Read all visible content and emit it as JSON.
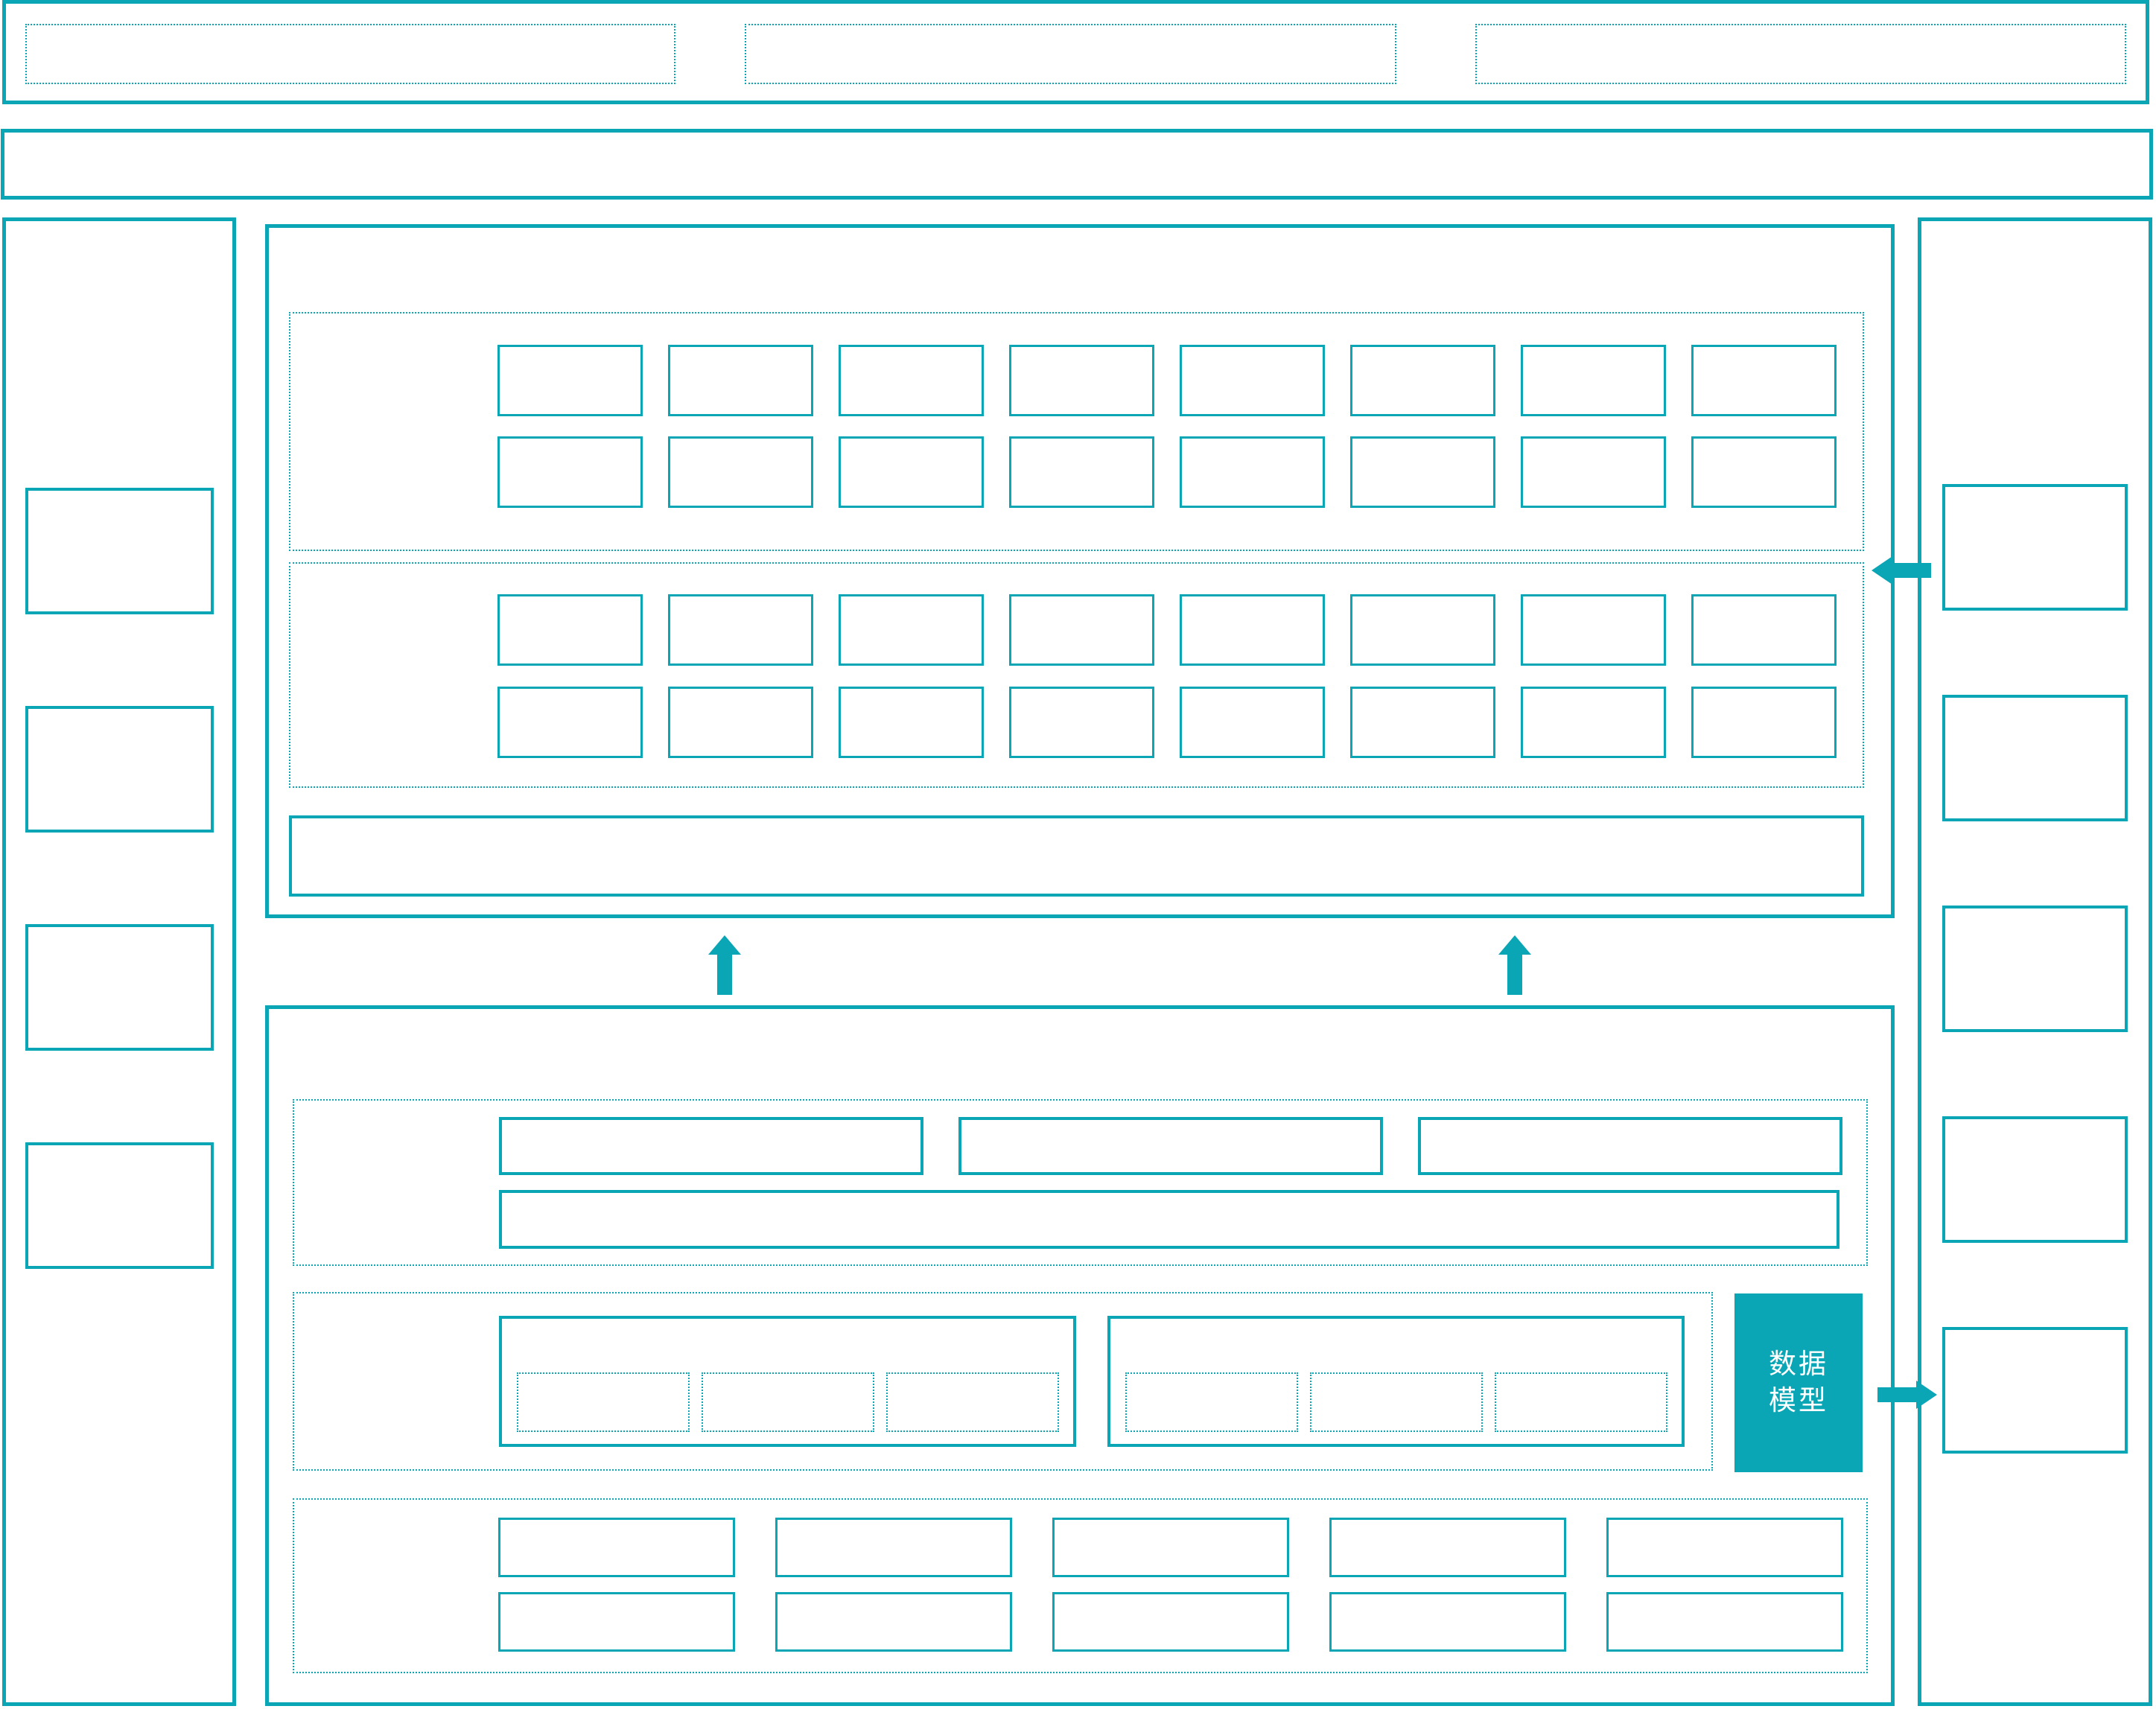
{
  "colors": {
    "accent": "#0aa6b5",
    "background": "#ffffff",
    "data_model_bg": "#0aa6b5",
    "data_model_text": "#ffffff"
  },
  "data_model_box": {
    "label": "数据模型",
    "line1": "数据",
    "line2": "模型"
  },
  "layout": {
    "top_bar_placeholders": 3,
    "upper_panel": {
      "sections": 2,
      "rows_per_section": 2,
      "cols": 8
    },
    "lower_panel": {
      "wide_boxes": 3,
      "groups": 2,
      "slots_per_group": 3,
      "bottom_rows": 2,
      "bottom_cols": 5
    },
    "left_sidebar_boxes": 4,
    "right_sidebar_boxes": 5
  }
}
